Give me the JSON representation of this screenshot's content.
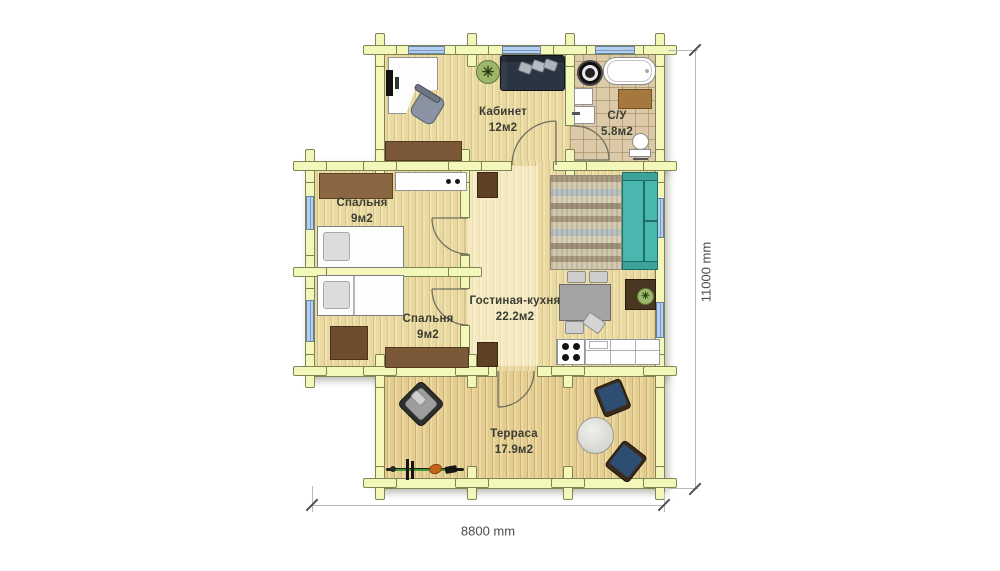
{
  "rooms": [
    {
      "name": "Кабинет",
      "area": "12м2"
    },
    {
      "name": "С/У",
      "area": "5.8м2"
    },
    {
      "name": "Спальня",
      "area": "9м2"
    },
    {
      "name": "Спальня",
      "area": "9м2"
    },
    {
      "name": "Гостиная-кухня",
      "area": "22.2м2"
    },
    {
      "name": "Терраса",
      "area": "17.9м2"
    }
  ],
  "dimensions": {
    "vertical": "11000 mm",
    "horizontal": "8800 mm"
  },
  "colors": {
    "wall_fill": "#f3f8ba",
    "wall_outline": "#7f8455",
    "wood_floor": "#eedfab",
    "tile_floor": "#dbc9a7",
    "window_blue": "#b4cff1",
    "teal_sofa": "#49b7ad",
    "navy_sofa": "#2b3442",
    "patio_chair_navy": "#2e4d73",
    "furniture_brown": "#7b5837",
    "label_text": "#3a3d34",
    "dimension_text": "#4c4c4c"
  },
  "furniture": [
    "office-desk",
    "office-chair",
    "potted-plant",
    "sofa",
    "sideboard",
    "washing-machine",
    "bathtub",
    "bathroom-cabinet",
    "sink",
    "bath-mat",
    "toilet",
    "hall-console",
    "cabinet",
    "cabinet",
    "bedroom-desk",
    "single-bed",
    "single-bed",
    "floor-chest",
    "dresser",
    "striped-rug",
    "teal-sofa",
    "plant-side-table",
    "dining-table",
    "dining-chair",
    "kitchen-counter",
    "stove",
    "lounge-chair",
    "bicycle",
    "round-coffee-table",
    "patio-armchair",
    "patio-armchair"
  ]
}
